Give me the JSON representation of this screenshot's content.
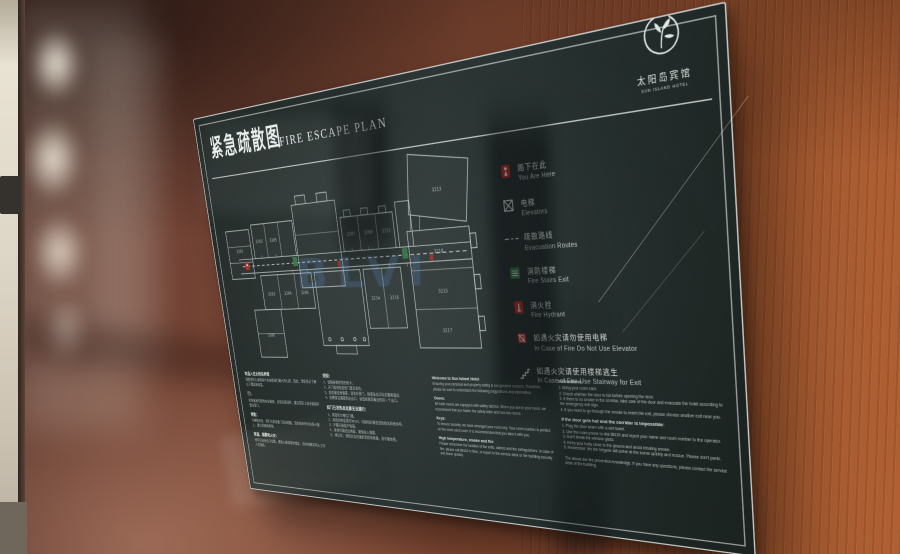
{
  "sign": {
    "title_zh": "紧急疏散图",
    "title_en": "FIRE ESCAPE PLAN",
    "logo": {
      "hotel_zh": "太阳岛宾馆",
      "hotel_en": "SUN ISLAND HOTEL"
    },
    "colors": {
      "panel": "#27302e",
      "accent_red": "#b63327",
      "accent_green": "#3f7d4e",
      "wood": "#8a4a30",
      "watermark_blue": "#5a8cd0"
    },
    "watermark_text": "BLVI",
    "plan": {
      "rooms": [
        "3201",
        "3203",
        "3205",
        "3207",
        "3209",
        "3211",
        "3213",
        "3218",
        "3215",
        "3217",
        "3214",
        "3216",
        "3202",
        "3204",
        "3206",
        "3208"
      ]
    },
    "legend": [
      {
        "icon": "you-are-here",
        "zh": "阁下在此",
        "en": "You Are Here"
      },
      {
        "icon": "elevator",
        "zh": "电梯",
        "en": "Elevators"
      },
      {
        "icon": "route",
        "zh": "疏散路线",
        "en": "Evacuation Routes"
      },
      {
        "icon": "stairs-exit",
        "zh": "消防楼梯",
        "en": "Fire Stairs Exit"
      },
      {
        "icon": "hydrant",
        "zh": "消火栓",
        "en": "Fire Hydrant"
      },
      {
        "icon": "no-elevator",
        "zh": "如遇火灾请勿使用电梯",
        "en": "In Case of Fire Do Not Use Elevator"
      },
      {
        "icon": "stairway",
        "zh": "如遇火灾请使用楼梯逃生",
        "en": "In Case of Fire Use Stairway for Exit"
      }
    ],
    "info": {
      "zh_welcome": {
        "sections": [
          {
            "heading": "欢迎入住太阳岛宾馆",
            "body": "保障您的人身和财产安全是我们最大的心愿，因此，请您务必了解以下建议和信息。"
          },
          {
            "heading": "门：",
            "body": "所有客房均配有安全锁链，当您在房间时，建议您扣上安全锁链并锁好房门。"
          },
          {
            "heading": "钥匙：",
            "body": "为确保安全，我们为您准备了房间钥匙，您的房间号印在房卡套上，建议您随身携带。"
          },
          {
            "heading": "高温、烟雾和火灾：",
            "body": "请牢记安全出口位置，遇到火情请保持镇定，及时报警并听从工作人员指挥。"
          }
        ]
      },
      "zh_instructions": {
        "sections": [
          {
            "heading": "须知：",
            "body": "1、请随身携带您的房卡。\n2、开门前请检查房门是否发热。\n3、如走廊没有烟雾，请关好房门，按紧急出口标志撤离酒店。\n4、如需穿过烟雾到达出口，请选择离您最近的另一个出口。"
          },
          {
            "heading": "如门已发热且走廊无法通行：",
            "body": "1、用湿毛巾堵住门缝。\n2、用房间电话拨打88119，向接线员报告您的姓名和房间号。\n3、不要打破窗户玻璃。\n4、身体尽量贴近地面，避免吸入烟雾。\n5、请记住：消防队会迅速赶到现场救援，请不要惊慌。"
          }
        ]
      },
      "en_welcome": {
        "sections": [
          {
            "heading": "Welcome to Sun Island Hotel",
            "body": "Ensuring your personal and property safety is our greatest concern. Therefore, please be sure to understand the following suggestions and information."
          },
          {
            "heading": "Doors:",
            "body": "All hotel rooms are equipped with safety latches. When you are in your room, we recommend that you fasten the safety latch and lock two doors."
          },
          {
            "heading": "Keys:",
            "body": "To ensure security, we have arranged your room key. Your room number is printed on the room card cover. It is recommended that you take it with you."
          },
          {
            "heading": "High temperature, smoke and fire",
            "body": "Please remember the location of the exits, alarms and fire extinguishers. In case of fire, please call 88119 in time, or report to the service desk or the building security and leave quickly."
          }
        ]
      },
      "en_instructions": {
        "sections": [
          {
            "heading": "Instructions:",
            "body": "1. Bring your room card.\n2. Check whether the door is hot before opening the door.\n3. If there is no smoke in the corridor, take care of the door and evacuate the hotel according to the emergency exit sign.\n4. If you need to go through the smoke to reach the exit, please choose another exit near you."
          },
          {
            "heading": "If the door gets hot and the corridor is impossible:",
            "body": "1. Plug the door seam with a wet towel.\n2. Use the room phone to dial 88119 and report your name and room number to the operator.\n3. Don't break the window glass.\n4. Keep your body close to the ground and avoid inhaling smoke.\n5. Remember: the fire brigade will arrive at the scene quickly and rescue. Please don't panic.\n\nThe above are fire prevention knowledge. If you have any questions, please contact the service desk of the building."
          }
        ]
      }
    }
  }
}
